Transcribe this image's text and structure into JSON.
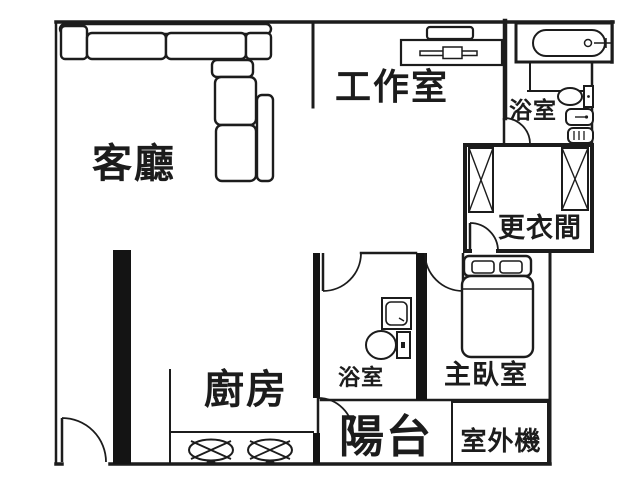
{
  "plan": {
    "title": "apartment-floor-plan",
    "rooms": {
      "living_room": "客廳",
      "studio": "工作室",
      "bathroom_top": "浴室",
      "dressing_room": "更衣間",
      "kitchen": "廚房",
      "bathroom_bottom": "浴室",
      "master_bedroom": "主臥室",
      "balcony": "陽台",
      "outdoor_unit": "室外機"
    },
    "colors": {
      "ink": "#1c1c1c",
      "paper": "#ffffff"
    }
  }
}
